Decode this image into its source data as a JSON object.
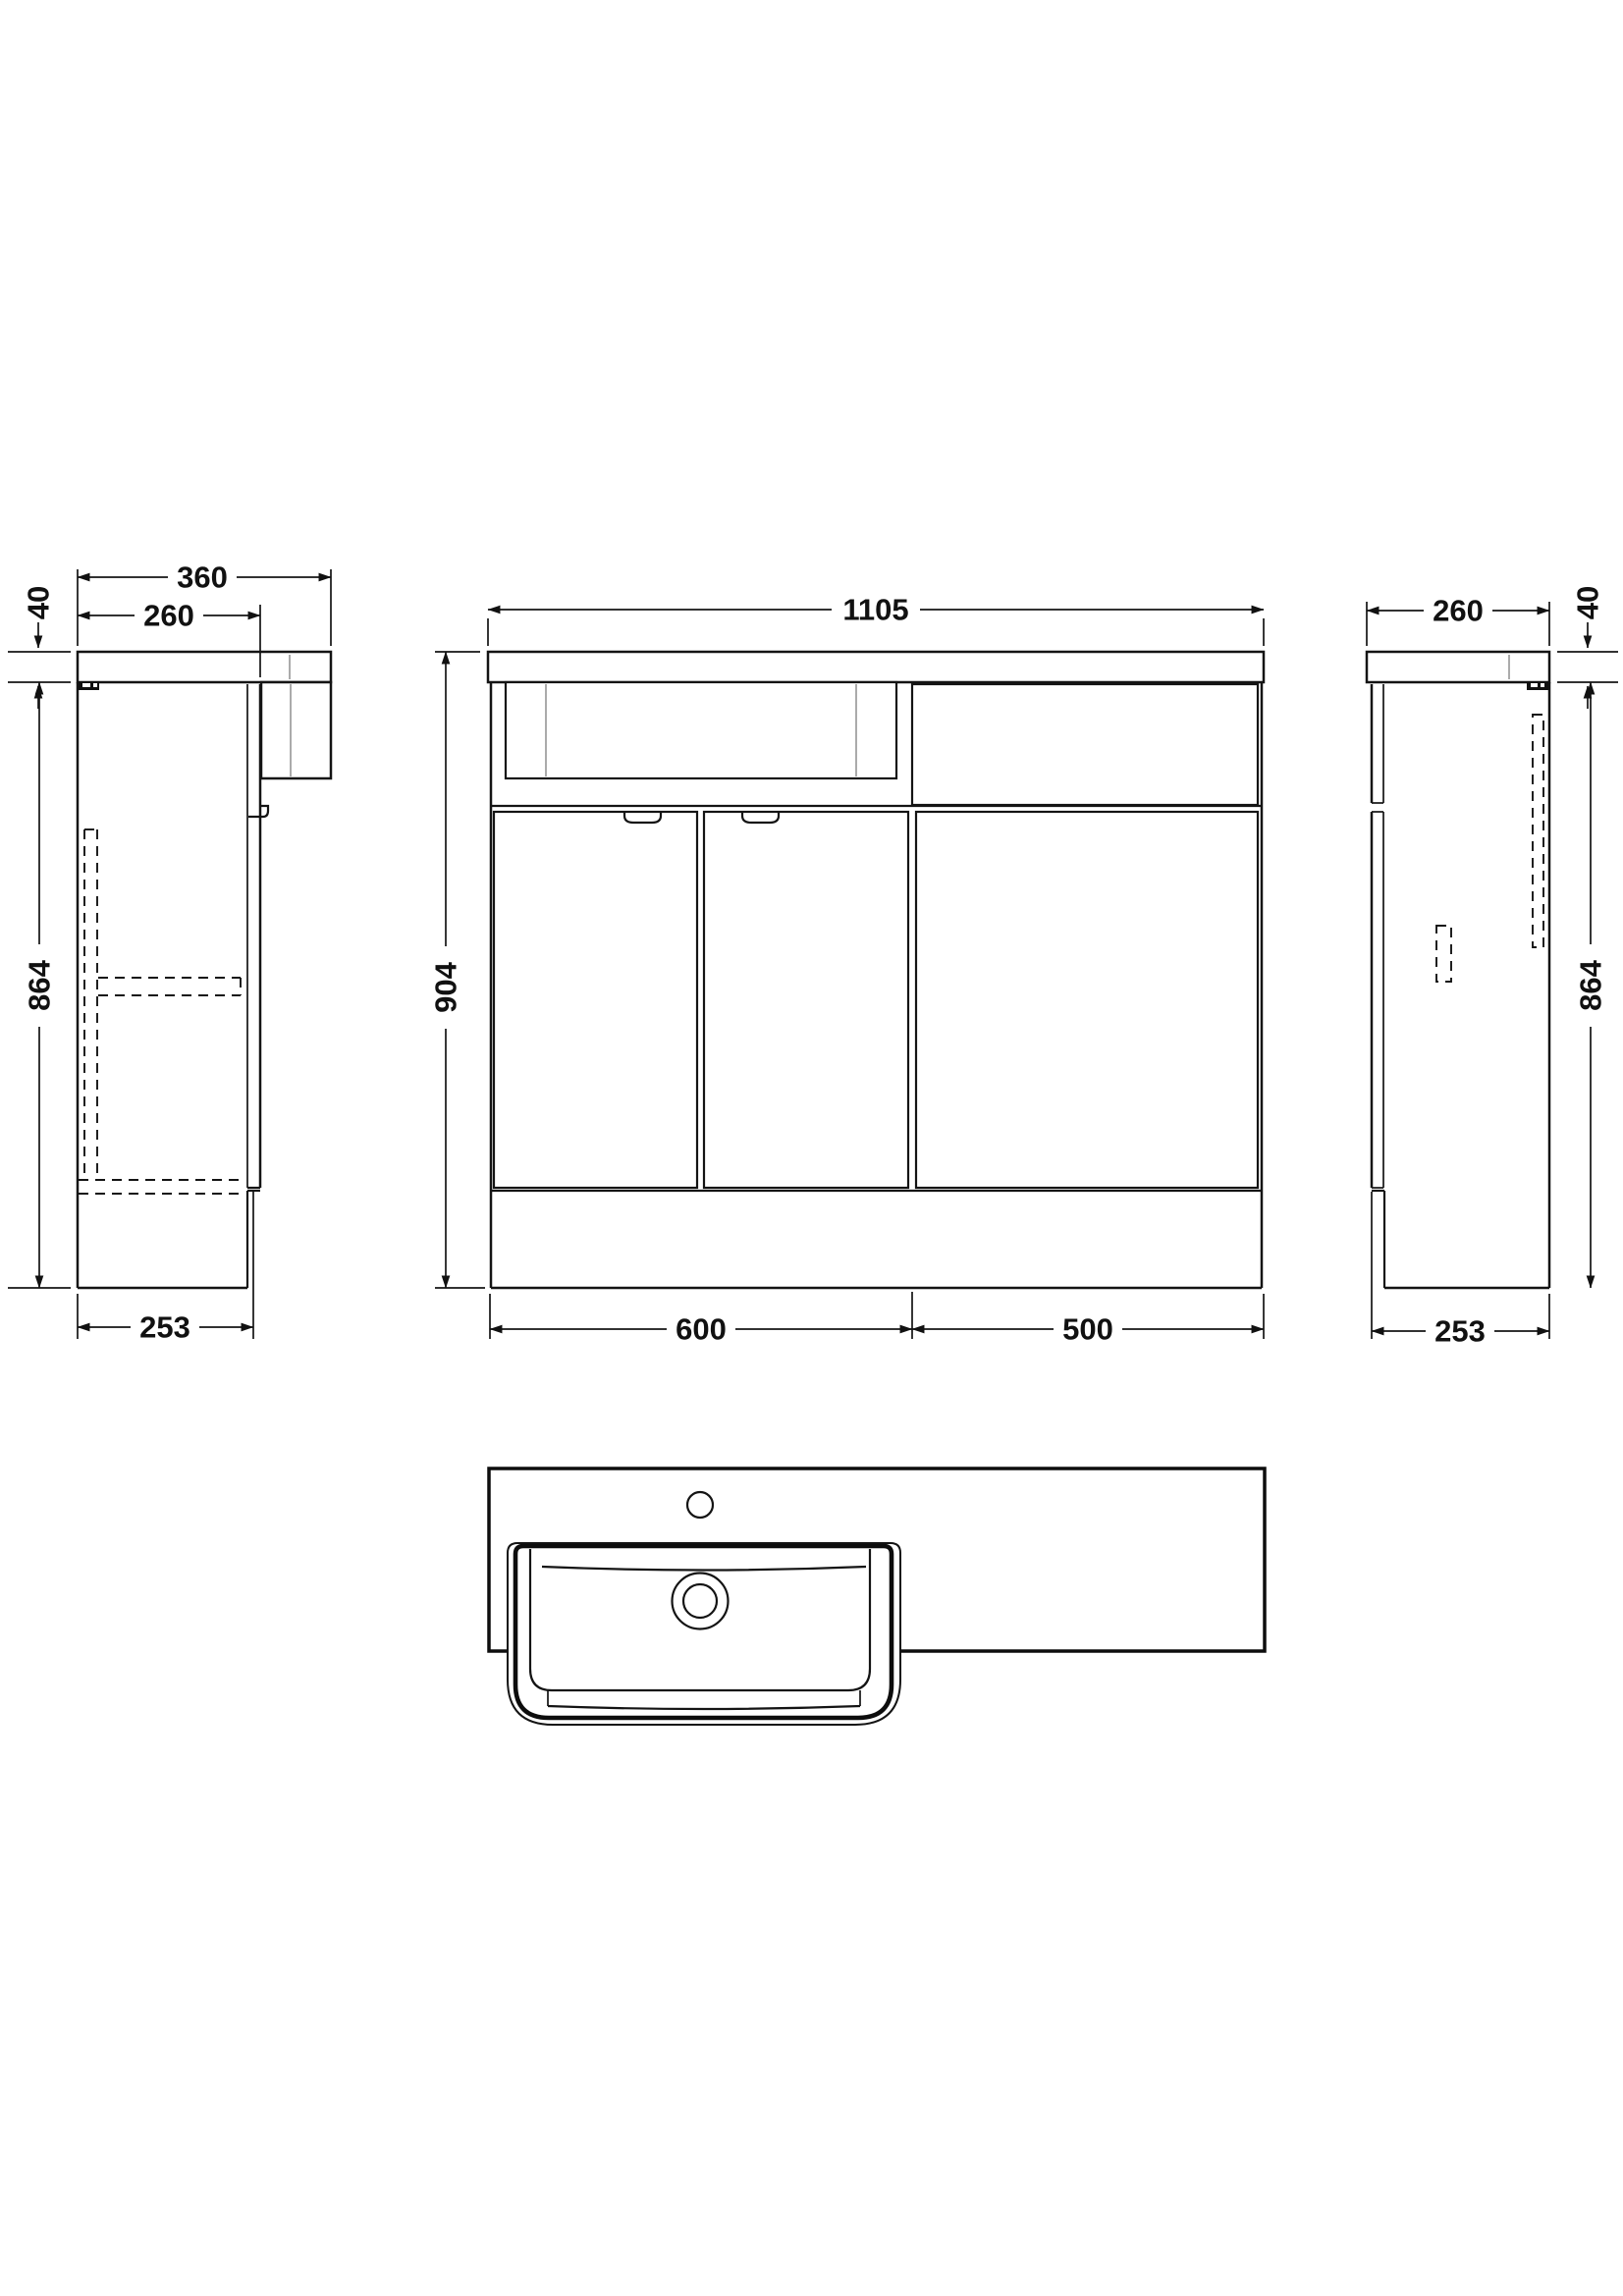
{
  "document": {
    "kind": "technical-orthographic-drawing",
    "subject": "combined vanity basin and WC bathroom furniture unit",
    "units": "mm",
    "line_color": "#141414",
    "background": "#ffffff"
  },
  "views": {
    "side_left": {
      "label": "left side elevation"
    },
    "front": {
      "label": "front elevation"
    },
    "side_right": {
      "label": "right side elevation"
    },
    "plan": {
      "label": "plan of worktop and basin"
    }
  },
  "dims": {
    "side_left": {
      "total_depth": "360",
      "worktop_thickness": "40",
      "cabinet_depth": "260",
      "cabinet_height": "864",
      "base_depth": "253"
    },
    "front": {
      "overall_width": "1105",
      "overall_height": "904",
      "vanity_unit_width": "600",
      "wc_unit_width": "500"
    },
    "side_right": {
      "worktop_depth": "260",
      "worktop_thickness": "40",
      "cabinet_height": "864",
      "base_depth": "253"
    }
  }
}
